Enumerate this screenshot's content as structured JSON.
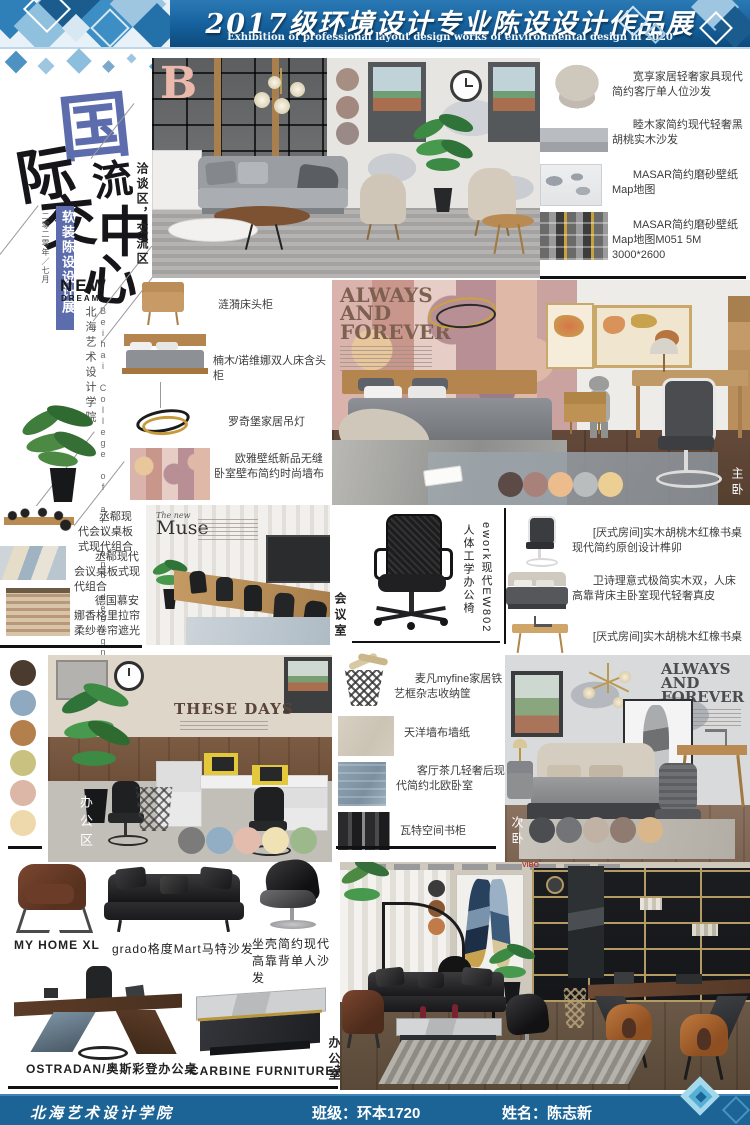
{
  "header": {
    "title": "2017级环境设计专业陈设设计作品展",
    "subtitle": "Exhibition of professional layout design works of environmental design in 2020"
  },
  "footer": {
    "school": "北海艺术设计学院",
    "class_text": "班级：环本1720",
    "name_text": "姓名：陈志新"
  },
  "hero": {
    "char1": "国",
    "char2": "际",
    "char3": "交",
    "char4": "流",
    "char5": "中",
    "char6": "心",
    "banner": "软装陈设设计展",
    "date_note": "二零二零年／七月",
    "new_word": "NEW",
    "dream_word": "DREAM",
    "school_cn": "北海艺术设计学院",
    "school_en": "Beihai College of art and design",
    "letter_b": "B"
  },
  "zones": {
    "negotiation": "洽谈区，交流区",
    "master": "主卧",
    "meeting": "会议室",
    "office_area": "办公区",
    "second": "次卧",
    "office_room": "办公室"
  },
  "posters": {
    "always1": [
      "ALWAYS",
      "AND",
      "FOREVER"
    ],
    "always2": [
      "ALWAYS",
      "AND",
      "FOREVER"
    ],
    "these_days": "THESE DAYS",
    "muse_small": "The new",
    "muse_big": "Muse",
    "vibo": "VIBO"
  },
  "annotations": {
    "top_right": [
      "宽享家居轻奢家具现代简约客厅单人位沙发",
      "睦木家简约现代轻奢黑胡桃实木沙发",
      "MASAR简约磨砂壁纸Map地图",
      "MASAR简约磨砂壁纸Map地图M051 5M 3000*2600"
    ],
    "bedroom_left": [
      "涟漪床头柜",
      "楠木/诺维娜双人床含头柜",
      "罗奇堡家居吊灯",
      "欧雅壁纸新品无缝卧室壁布简约时尚墙布"
    ],
    "meeting_left": [
      "丞郗现代会议桌板式现代组合",
      "丞郗现代会议桌板式现代组合",
      "德国慕安娜香格里拉帘柔纱卷帘遮光"
    ],
    "chair_model": "ework现代EW802",
    "chair_desc": "人体工学办公椅",
    "study_right": [
      "[厌式房间]实木胡桃木红橡书桌现代简约原创设计榫卯",
      "卫诗理意式极简实木双，人床高靠背床主卧室现代轻奢真皮",
      "[厌式房间]实木胡桃木红橡书桌"
    ],
    "office_mid": [
      "麦凡myfine家居铁艺框杂志收纳筐",
      "天洋墙布墙纸",
      "客厅茶几轻奢后现代简约北欧卧室",
      "瓦特空间书柜"
    ]
  },
  "products": [
    "MY HOME XL",
    "grado格度Mart马特沙发",
    "坐壳简约现代高靠背单人沙发",
    "OSTRADAN/奥斯彩登办公桌",
    "CARBINE FURNITURE茶几"
  ],
  "palettes": {
    "living": [
      "#a78e82",
      "#a2887f",
      "#998a86"
    ],
    "master": [
      "#5c4a46",
      "#a8817b",
      "#ecbc8c",
      "#b9bdbd",
      "#eccf92"
    ],
    "office_col": [
      "#4a3b2e",
      "#8fa9c0",
      "#b3804d",
      "#c9c17f",
      "#dcb6a6",
      "#eed9ad"
    ],
    "office": [
      "#7b7b79",
      "#92aec4",
      "#e3bcae",
      "#f0e2b4",
      "#9cb98c"
    ],
    "second": [
      "#4b4d50",
      "#737478",
      "#c0b2a4",
      "#8f7b70",
      "#d9b78a"
    ],
    "exec": [
      "#3b3b3b",
      "#8a5733",
      "#c17a4a"
    ]
  },
  "colors": {
    "header_blue": "#15609c",
    "footer_blue": "#1c6396",
    "accent_indigo": "#5c6cac"
  }
}
